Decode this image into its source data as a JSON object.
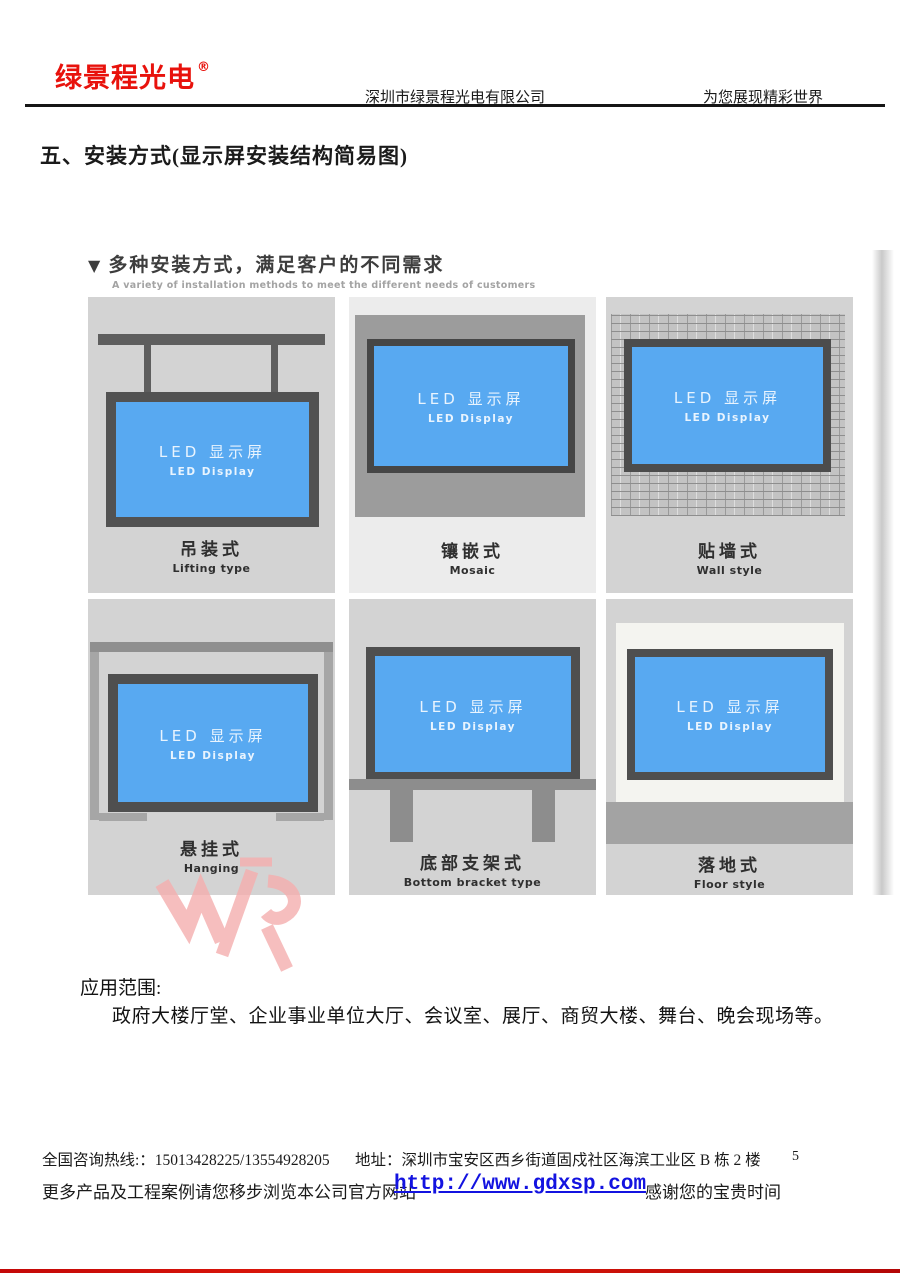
{
  "header": {
    "logo": "绿景程光电",
    "registered_mark": "®",
    "company": "深圳市绿景程光电有限公司",
    "slogan": "为您展现精彩世界"
  },
  "section_title": "五、安装方式(显示屏安装结构简易图)",
  "figure": {
    "title_marker": "▼",
    "title": "多种安装方式，满足客户的不同需求",
    "subtitle": "A variety of installation methods to meet the different needs of customers",
    "screen_label_zh": "LED 显示屏",
    "screen_label_en": "LED Display",
    "panels": [
      {
        "zh": "吊装式",
        "en": "Lifting type"
      },
      {
        "zh": "镶嵌式",
        "en": "Mosaic"
      },
      {
        "zh": "贴墙式",
        "en": "Wall style"
      },
      {
        "zh": "悬挂式",
        "en": "Hanging"
      },
      {
        "zh": "底部支架式",
        "en": "Bottom bracket type"
      },
      {
        "zh": "落地式",
        "en": "Floor style"
      }
    ],
    "colors": {
      "screen_blue": "#58a9f1",
      "frame_dark": "#525252",
      "panel_gray": "#d3d3d3"
    }
  },
  "application": {
    "heading": "应用范围:",
    "body": "政府大楼厅堂、企业事业单位大厅、会议室、展厅、商贸大楼、舞台、晚会现场等。"
  },
  "footer": {
    "hotline": "全国咨询热线:：15013428225/13554928205",
    "address": "地址：深圳市宝安区西乡街道固戍社区海滨工业区 B 栋 2 楼",
    "page_number": "5",
    "more_text": "更多产品及工程案例请您移步浏览本公司官方网站",
    "website": "http://www.gdxsp.com",
    "thanks": "感谢您的宝贵时间"
  },
  "colors": {
    "brand_red": "#e8120c",
    "link_blue": "#1313e0"
  }
}
